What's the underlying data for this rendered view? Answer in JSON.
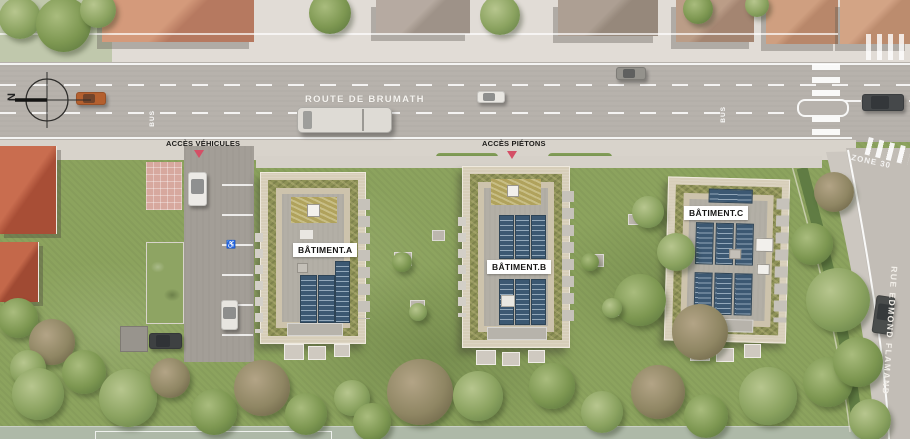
{
  "plan": {
    "type": "site-plan",
    "description": "Plan masse résidentiel"
  },
  "compass": {
    "north_label": "N"
  },
  "roads": {
    "main_road_name": "ROUTE DE BRUMATH",
    "side_road_name": "RUE EDMOND FLAMAND",
    "zone_marking": "ZONE 30",
    "bus_lane_marking": "BUS"
  },
  "access": {
    "vehicles_label": "ACCÈS VÉHICULES",
    "pedestrians_label": "ACCÈS PIÉTONS"
  },
  "buildings": [
    {
      "label": "BÂTIMENT.A"
    },
    {
      "label": "BÂTIMENT.B"
    },
    {
      "label": "BÂTIMENT.C"
    }
  ],
  "colors": {
    "grass": "#8ca35e",
    "road": "#b7b2ac",
    "roof_gravel": "#d7ceb9",
    "roof_vegetal": "#8e9257",
    "solar_panel": "#3c5872",
    "access_marker": "#d44f66",
    "label_tag_bg": "#ffffff"
  }
}
